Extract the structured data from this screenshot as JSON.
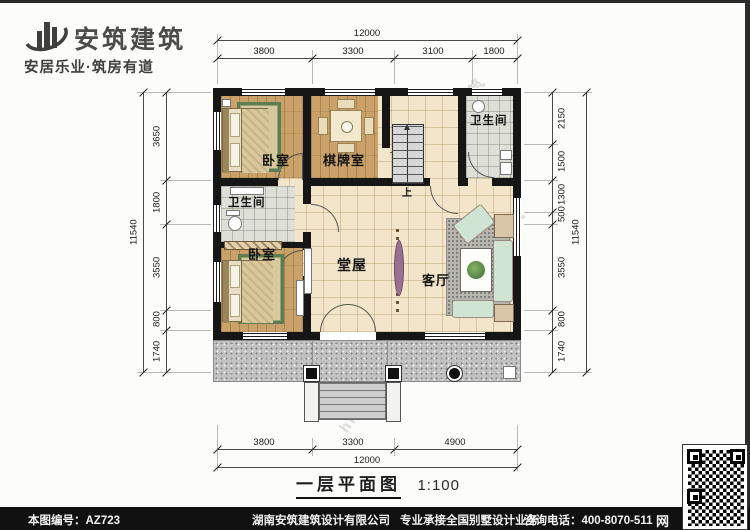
{
  "brand": {
    "name": "安筑建筑",
    "tagline": "安居乐业·筑房有道"
  },
  "plan": {
    "rooms": {
      "bedroom_top": "卧室",
      "game_room": "棋牌室",
      "bath_mid": "卫生间",
      "bath_top_right": "卫生间",
      "bedroom_bottom": "卧室",
      "hall": "堂屋",
      "living_room": "客厅",
      "stairs_up": "上"
    }
  },
  "dimensions": {
    "top": {
      "total": "12000",
      "segments": [
        "3800",
        "3300",
        "3100",
        "1800"
      ]
    },
    "bottom": {
      "total": "12000",
      "segments": [
        "3800",
        "3300",
        "4900"
      ]
    },
    "left": {
      "total": "11540",
      "segments": [
        "3650",
        "1800",
        "3550",
        "800",
        "1740"
      ]
    },
    "right": {
      "total": "11540",
      "segments": [
        "2150",
        "1500",
        "1300",
        "500",
        "3550",
        "800",
        "1740"
      ]
    }
  },
  "title_block": {
    "name": "一层平面图",
    "scale": "1:100"
  },
  "footer": {
    "drawing_no": "本图编号：AZ723",
    "company": "湖南安筑建筑设计有限公司",
    "service": "专业承接全国别墅设计业务",
    "phone": "咨询电话：400-8070-511",
    "net": "网"
  },
  "watermarks": [
    "安筑建筑",
    "安筑建筑",
    "hnaz-jz·com",
    "安筑建筑"
  ],
  "colors": {
    "wall": "#161616",
    "wood_floor": "#c9a169",
    "tile_floor": "#f2e5c9",
    "bath_floor": "#dedfd6",
    "porch": "#c2c2c2",
    "footer_bg": "#111111"
  }
}
